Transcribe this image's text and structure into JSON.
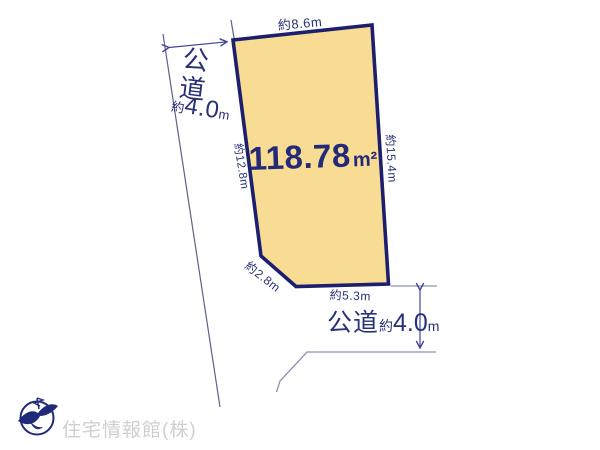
{
  "parcel": {
    "area_value": "118.78",
    "area_unit": "m²",
    "dimensions": {
      "top": "約8.6m",
      "right": "約15.4m",
      "left": "約12.8m",
      "corner": "約2.8m",
      "bottom": "約5.3m"
    }
  },
  "roads": {
    "left": {
      "name": "公道",
      "width_prefix": "約",
      "width_value": "4.0",
      "width_unit": "m"
    },
    "bottom": {
      "name": "公道",
      "width_prefix": "約",
      "width_value": "4.0",
      "width_unit": "m"
    }
  },
  "footer": {
    "company": "住宅情報館(株)"
  },
  "colors": {
    "parcel_fill": "#f8dc94",
    "parcel_border": "#1c1f6e",
    "dimension_text": "#283178",
    "road_line": "#5c6288",
    "guide_line": "#8b93af",
    "arrow": "#3f459a",
    "logo_navy": "#1f2a7a",
    "watermark": "#cfcfcf"
  }
}
